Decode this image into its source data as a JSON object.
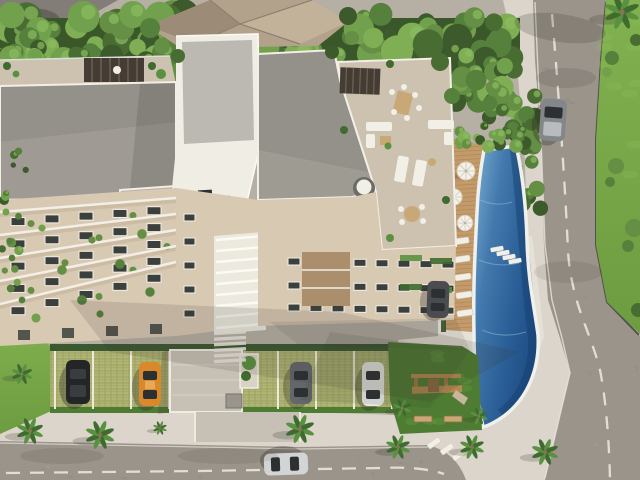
{
  "scene": {
    "title": "Aerial 3D rendering of a residential condominium complex",
    "description": "Bird's-eye architectural visualization: flat-roof apartment towers with rooftop lounge terraces and pergolas, an elongated outdoor pool with timber deck and white parasols, grass-grid parking stalls with cars, a playground lawn, palm-lined sidewalks, dense tree canopy to the north and two asphalt streets meeting at a rounded corner.",
    "time_of_day": "daytime",
    "style": "photorealistic render, no text or UI elements visible"
  },
  "palette": {
    "plaza": "#b6afa4",
    "plaza_light": "#c6c0b5",
    "dark_roof_corner": "#827d76",
    "sidewalk": "#dbd5cb",
    "sidewalk_bright": "#e6e1d7",
    "asphalt": "#9b948b",
    "asphalt_dark": "#8b857c",
    "marking": "#e9e6de",
    "curb": "#55514a",
    "grass": "#7fae4e",
    "grass_dark": "#6d9c41",
    "lawn": "#4e7c33",
    "grass_grid": "#a7ac6d",
    "grid_line": "#b9bd7c",
    "hedge": "#35532b",
    "tree_greens": [
      "#3c5a2b",
      "#496c33",
      "#56813c",
      "#648f44",
      "#72a14d",
      "#7fae55"
    ],
    "tree_highlight": "#8cbc60",
    "roof_gray": "#94918b",
    "roof_gray_light": "#a5a199",
    "roof_pent": "#bcb8b2",
    "shingle": "#b3a28b",
    "shingle_dark": "#9c8c77",
    "shingle_light": "#c2b29a",
    "wall_white": "#f0ede5",
    "parapet": "#f3efe6",
    "wall_beige": "#d8c9b3",
    "wall_beige_dark": "#c4b098",
    "terrace": "#cdc1af",
    "accent_brown": "#ab8e6c",
    "window": "#3b403c",
    "frame": "#f2efe8",
    "glass": "#2c3033",
    "louver": "#eceade",
    "deck": "#c39a6a",
    "deck_line": "#a37e51",
    "pool_edge": "#f0f1ec",
    "furn_white": "#f2efe7",
    "furn_tan": "#c8a877",
    "pergola": "#453c33",
    "play_wood": "#b5884f",
    "palm_frond": "#3f6b2e",
    "palm_frond_light": "#5a9140",
    "trunk": "#8a7354",
    "shadow": "rgba(58,54,46,0.22)"
  },
  "buildings": {
    "tower_count": 3,
    "roof_types": [
      "flat gray membrane",
      "white penthouse volume",
      "tan hip shingle roof of neighboring house"
    ],
    "facades": "beige walls, white balcony rails with planters, dark windows",
    "amenities": [
      "rooftop pergola lounge",
      "rooftop dining table",
      "sun loungers",
      "round daybed",
      "white louvered stair core"
    ]
  },
  "pool": {
    "shape": "elongated freeform pool with rounded south end",
    "water_colors": [
      "#7db1d4",
      "#4379ad",
      "#2b5f97",
      "#1d4c83"
    ],
    "deck": "timber deck with white loungers",
    "parasol_count": 3,
    "in_water_lounger_count": 4
  },
  "vehicles": [
    {
      "name": "van-on-east-street",
      "color": "#84878a"
    },
    {
      "name": "sedan-by-building",
      "color": "#4a4c4f"
    },
    {
      "name": "black-suv-stall",
      "color": "#232527"
    },
    {
      "name": "orange-car-stall",
      "color": "#d9882a"
    },
    {
      "name": "gray-car-stall",
      "color": "#63666a"
    },
    {
      "name": "white-car-stall",
      "color": "#e9e9e7"
    },
    {
      "name": "silver-car-south-street",
      "color": "#d3d4d4"
    }
  ],
  "landscape": {
    "palm_count": 11,
    "canopy": "dense mixed tree canopy along the north edge and beside the pool",
    "lawns": [
      "east grass verge",
      "southwest grass wedge",
      "playground lawn"
    ],
    "parking_surface": "grass-grid permeable pavers with white stall dividers",
    "playground": "wooden play structure with two benches on lawn"
  },
  "streets": {
    "east_street": "diagonal avenue with dashed white center line",
    "south_street": "street with dashed white center line and rounded sidewalk corner",
    "crosswalk": "white zebra crossing at building entrance"
  }
}
